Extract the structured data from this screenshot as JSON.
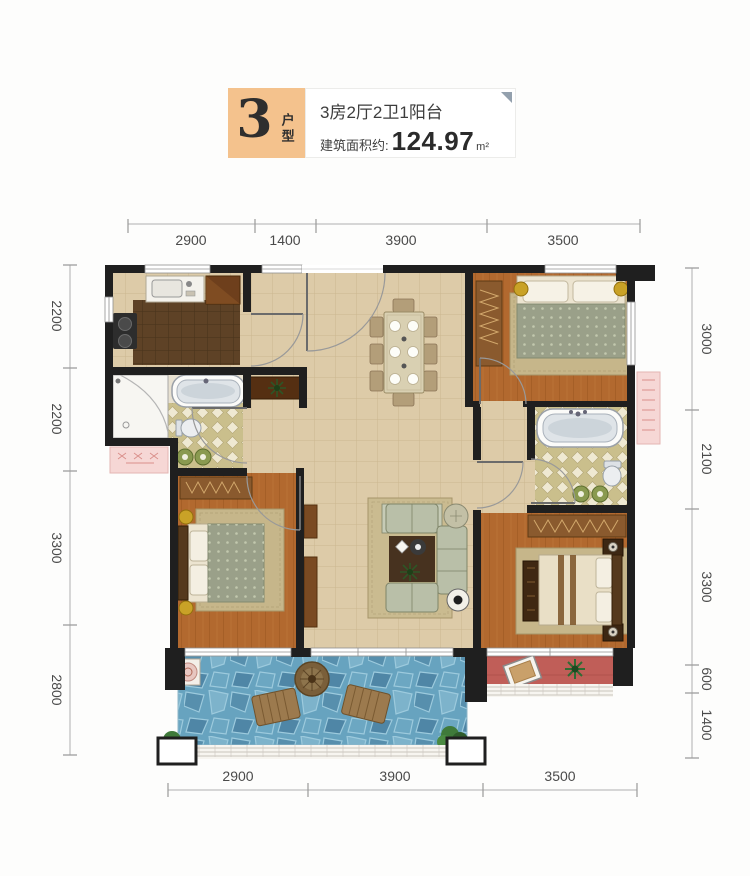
{
  "header": {
    "unit_number": "3",
    "unit_label": "户型",
    "layout": "3房2厅2卫1阳台",
    "area_label": "建筑面积约:",
    "area_value": "124.97",
    "area_unit": "m²"
  },
  "dimensions": {
    "top": [
      "2900",
      "1400",
      "3900",
      "3500"
    ],
    "bottom": [
      "2900",
      "3900",
      "3500"
    ],
    "left": [
      "2200",
      "2200",
      "3300",
      "2800"
    ],
    "right": [
      "3000",
      "2100",
      "3300",
      "600",
      "1400"
    ]
  },
  "colors": {
    "accent": "#f4c28d",
    "wall": "#1f1f1f",
    "floor_tile": "#ddcba8",
    "wood": "#b2692f",
    "bath_tile": "#cabf8c",
    "kitchen_tile": "#5e4226",
    "balcony_stone": "#67a3bf",
    "red_balcony": "#c05e58",
    "ac_platform": "#f6d7d5"
  }
}
